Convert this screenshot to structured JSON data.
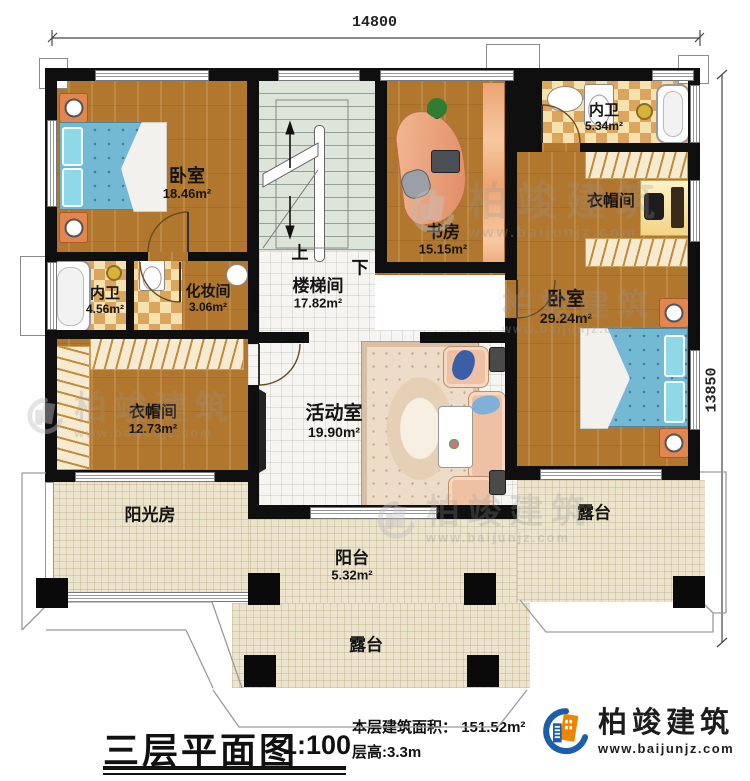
{
  "dimensions": {
    "width": "14800",
    "height": "13850"
  },
  "rooms": {
    "bedroom_left": {
      "name": "卧室",
      "area": "18.46m²"
    },
    "stair_hall": {
      "name": "楼梯间",
      "area": "17.82m²"
    },
    "study": {
      "name": "书房",
      "area": "15.15m²"
    },
    "bath_top": {
      "name": "内卫",
      "area": "5.34m²"
    },
    "closet_top": {
      "name": "衣帽间"
    },
    "bath_left": {
      "name": "内卫",
      "area": "4.56m²"
    },
    "makeup": {
      "name": "化妆间",
      "area": "3.06m²"
    },
    "closet_left": {
      "name": "衣帽间",
      "area": "12.73m²"
    },
    "activity": {
      "name": "活动室",
      "area": "19.90m²"
    },
    "bedroom_right": {
      "name": "卧室",
      "area": "29.24m²"
    },
    "sunroom": {
      "name": "阳光房"
    },
    "balcony": {
      "name": "阳台",
      "area": "5.32m²"
    },
    "terrace_right": {
      "name": "露台"
    },
    "terrace_bottom": {
      "name": "露台"
    }
  },
  "stairs": {
    "up": "上",
    "down": "下"
  },
  "footer": {
    "title": "三层平面图",
    "scale": "1:100",
    "area_label": "本层建筑面积：",
    "area_value": "151.52m²",
    "floor_height": "层高:3.3m"
  },
  "brand": {
    "name": "柏竣建筑",
    "website": "www.baijunjz.com"
  },
  "colors": {
    "wood_floor": "#b2772e",
    "checker_tile": "#dca55e",
    "bed_blue": "#74b9d4",
    "wall": "#0f0f0f",
    "logo_blue": "#1a5fa8",
    "logo_orange": "#f08300",
    "terrace_floor": "#ece4cd",
    "stair_floor": "#dde4da"
  }
}
